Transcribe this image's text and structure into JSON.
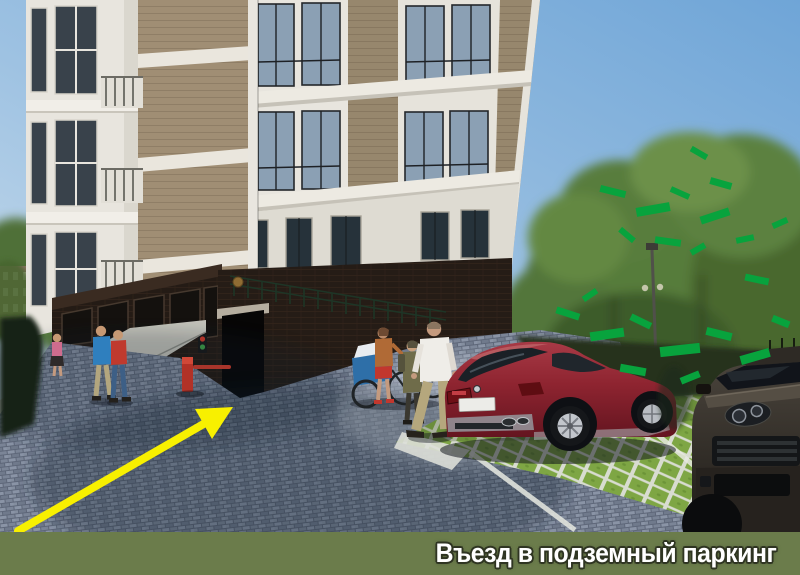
{
  "banner": {
    "caption": "Въезд в подземный паркинг",
    "background_color": "#6B7C4B",
    "text_color": "#FFFFFF",
    "outline_color": "#2F3522"
  },
  "annotation_arrow": {
    "color": "#F8F000",
    "points_to": "underground parking entrance ramp"
  },
  "scene": {
    "type": "3d architectural rendering",
    "subject": "courtyard of a residential building with ramp down to underground parking",
    "elements": {
      "building": "beige multi-storey residential building, white window bays and trim, dark brick ground floor with storefronts",
      "parking_entrance": "dark ramp opening in the brick base with concrete lintel and green railing above",
      "barrier": "red parking barrier post with boom at the ramp",
      "traffic_light": "small red/green signal lamp on the wall by the ramp",
      "pedestrians": [
        "man in white t-shirt and khaki trousers",
        "woman in orange top with bicycle and blue child trailer",
        "person in olive jacket",
        "man in blue t-shirt",
        "man in red t-shirt",
        "woman in pink top on sidewalk"
      ],
      "vehicles": [
        "dark red crossover parked on grass pavers",
        "dark grey SUV front at right edge"
      ],
      "ground": [
        "grey cobblestone driveway",
        "green grass-grid parking pavers with white lines",
        "light concrete sidewalk"
      ],
      "vegetation": "large trees and hedge with flat bright-green rendering artifacts",
      "street_lamp": "thin lamp post among the trees"
    },
    "colors": {
      "sky": "#7FAFD9",
      "building_wall": "#9C8B72",
      "building_trim": "#EAE7DF",
      "brick_base": "#241B15",
      "pavement": "#818B9D",
      "grass_pavers": "#7EA644",
      "red_car": "#93252F",
      "dark_car": "#332E28",
      "foliage": "#4F7036",
      "foliage_artifact": "#08A33D"
    }
  }
}
